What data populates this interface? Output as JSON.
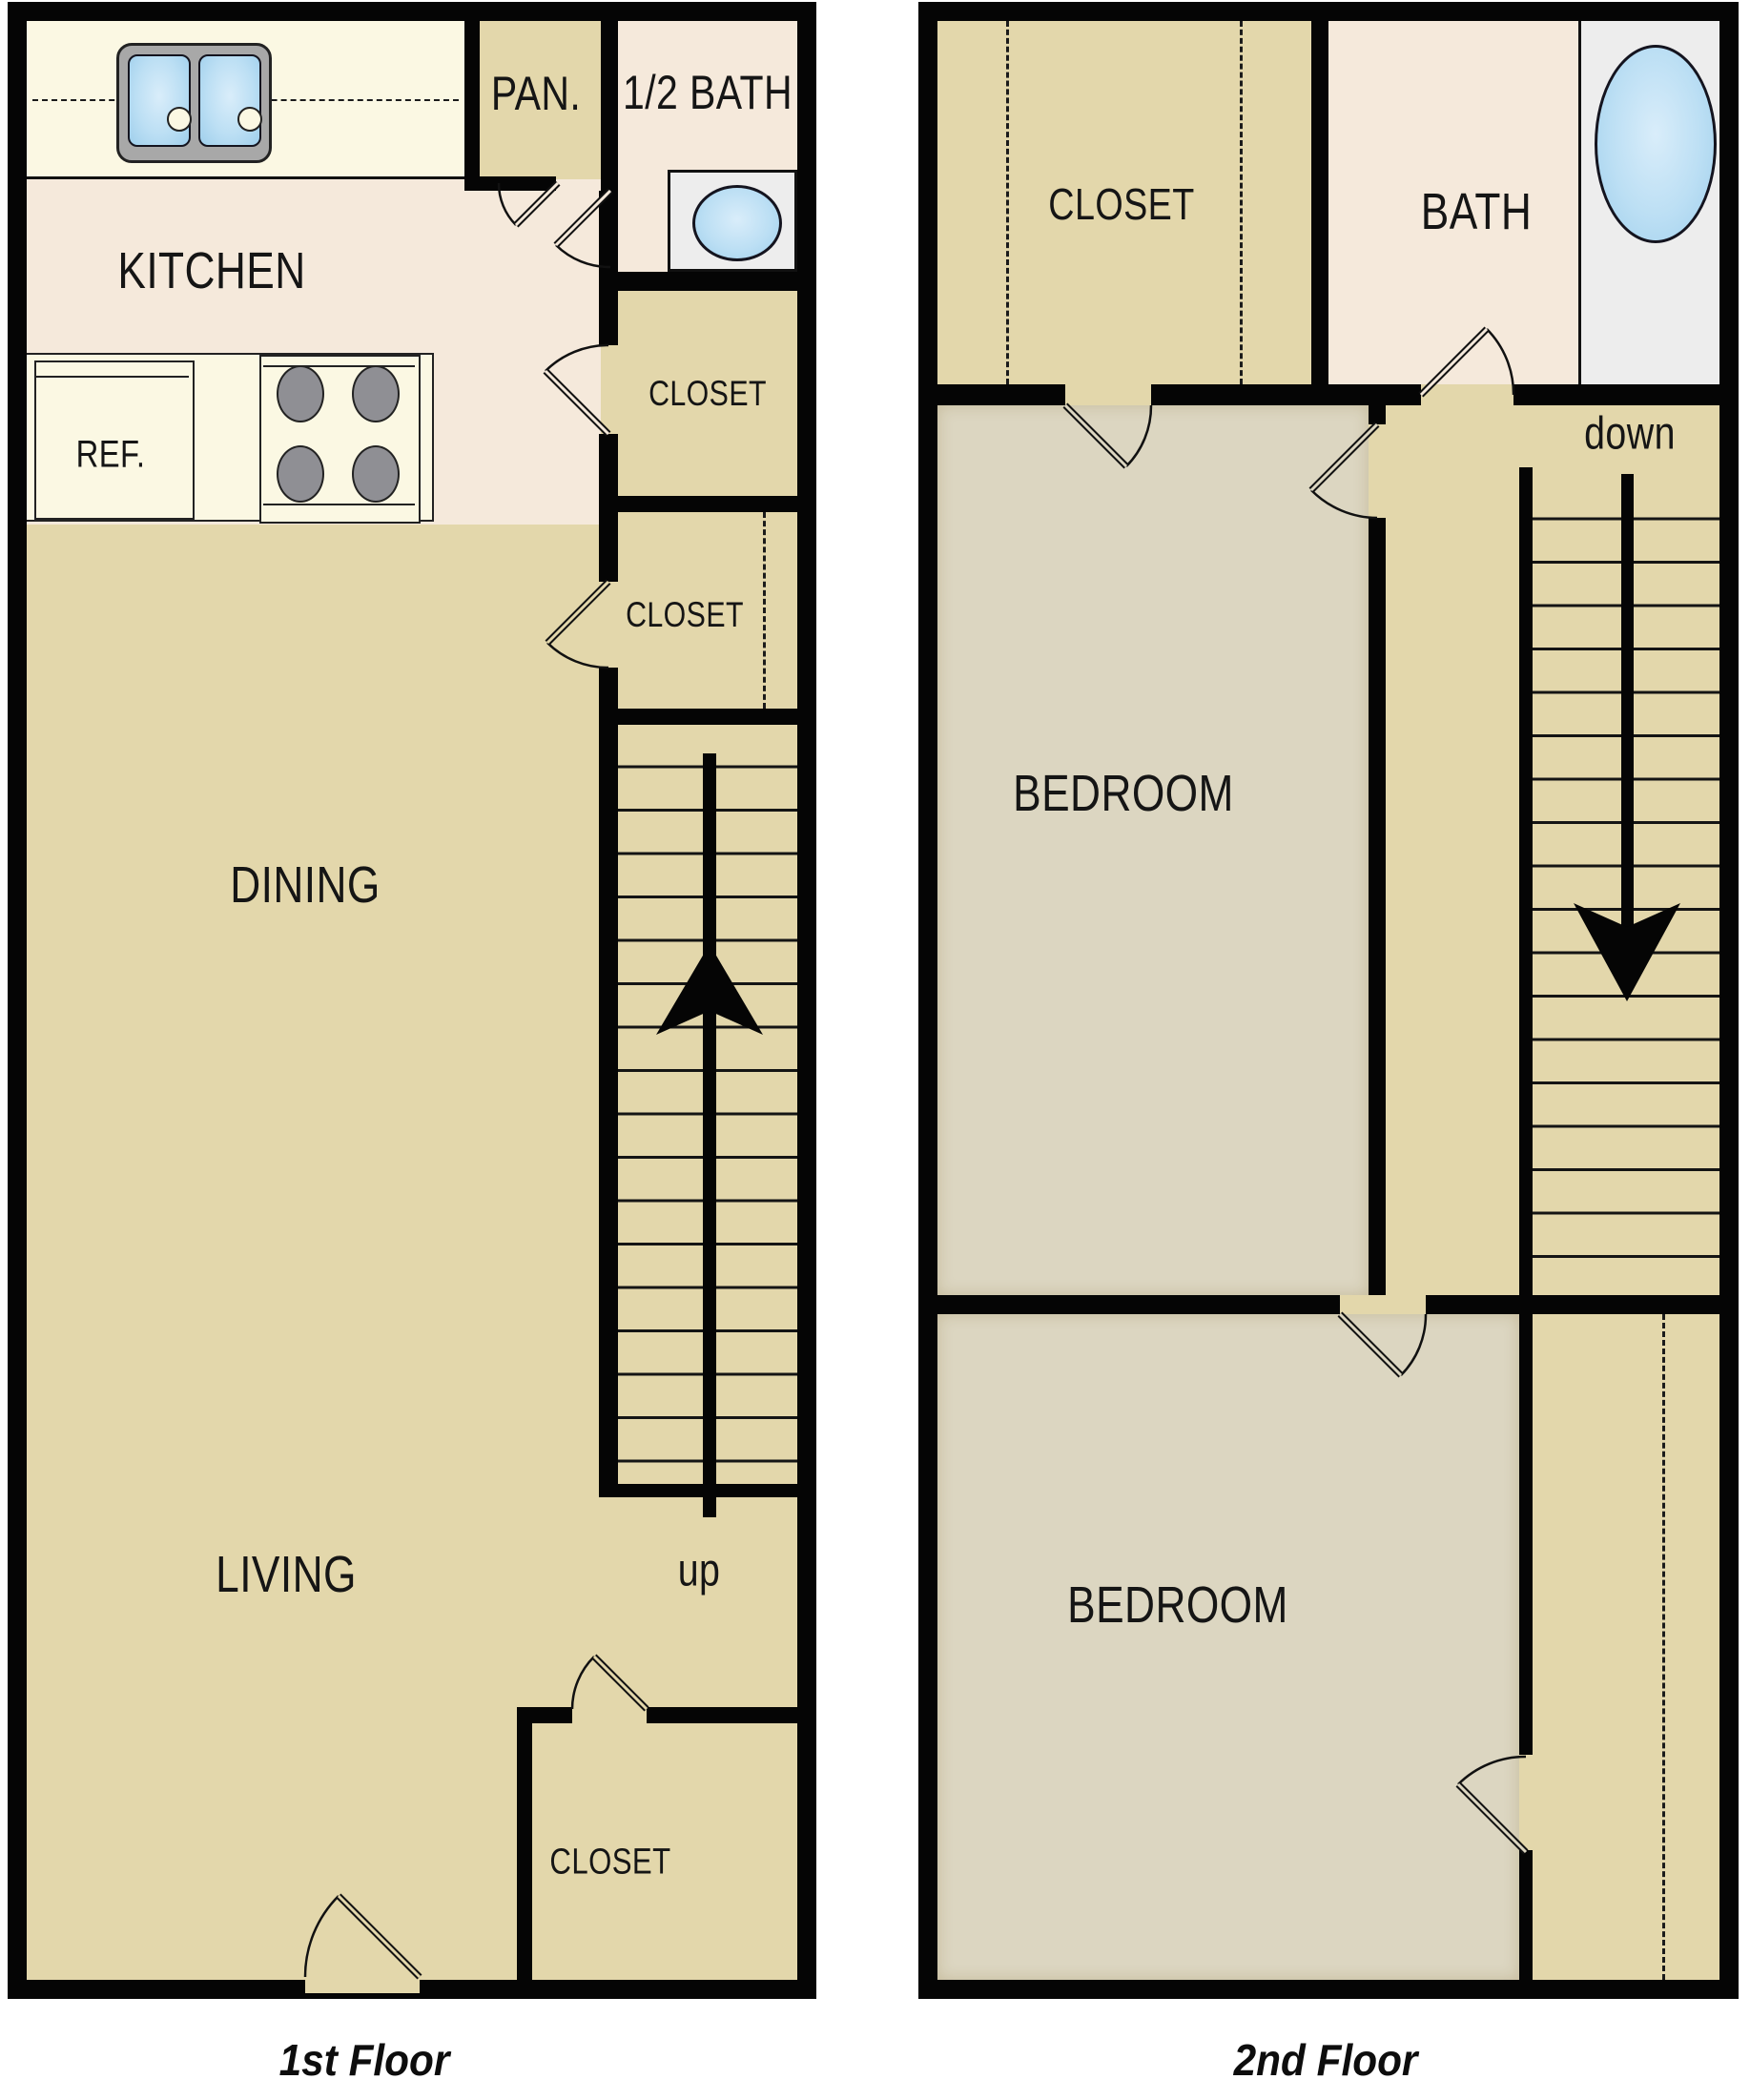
{
  "document": {
    "type": "apartment floor plan, two-story townhouse",
    "background": "#ffffff"
  },
  "colors": {
    "wall": "#050505",
    "floor_tan": "#E3D7AB",
    "floor_peach": "#F5E9DB",
    "counter_cream": "#FBF8E3",
    "floor_bedroom_gray": "#DCD6C1",
    "fixture_white": "#EDEDED",
    "water_blue": "#BCDFF4",
    "burner_gray": "#8F8F94",
    "sink_rim_gray": "#A8A8A8"
  },
  "floor1": {
    "caption": "1st Floor",
    "labels": {
      "kitchen": "KITCHEN",
      "pantry": "PAN.",
      "half_bath": "1/2 BATH",
      "closet_upper": "CLOSET",
      "closet_lower": "CLOSET",
      "dining": "DINING",
      "living": "LIVING",
      "entry_closet": "CLOSET",
      "fridge": "REF.",
      "stair_direction": "up"
    }
  },
  "floor2": {
    "caption": "2nd Floor",
    "labels": {
      "closet": "CLOSET",
      "bath": "BATH",
      "bedroom_front": "BEDROOM",
      "bedroom_rear": "BEDROOM",
      "stair_direction": "down"
    }
  }
}
